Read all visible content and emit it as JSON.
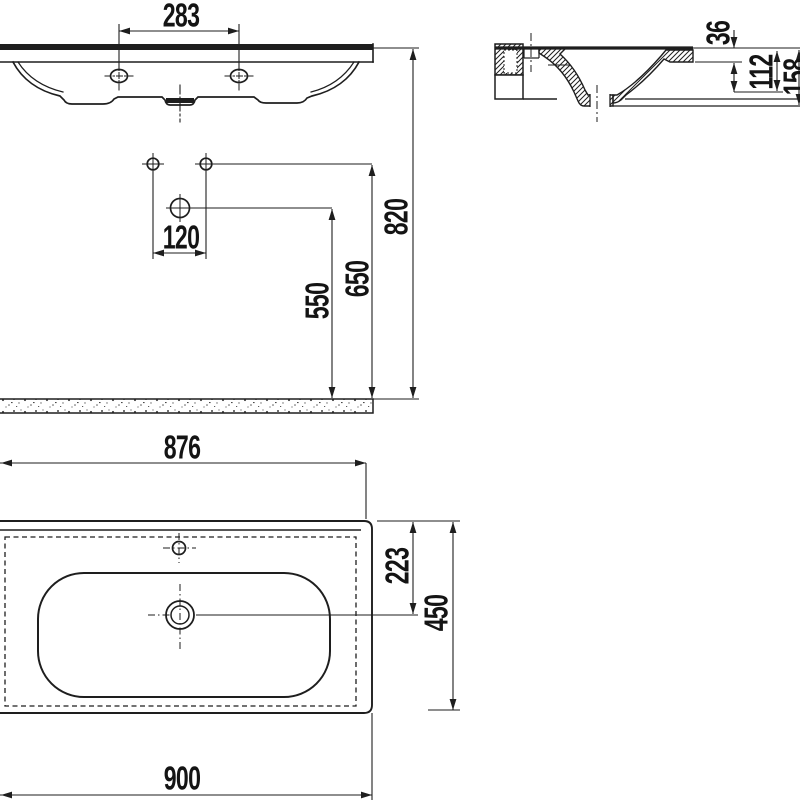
{
  "drawing_type": "washbasin technical dimension drawing",
  "colors": {
    "line": "#1e1e1e",
    "background": "#ffffff",
    "text": "#141414"
  },
  "dims": {
    "tap_hole_spacing": "283",
    "fixing_hole_spacing": "120",
    "drain_height": "550",
    "fixing_hole_height": "650",
    "rim_height": "820",
    "rim_thickness": "36",
    "basin_depth": "112",
    "side_total_height": "158",
    "top_width": "876",
    "overall_width": "900",
    "drain_from_back": "223",
    "overall_depth": "450"
  }
}
